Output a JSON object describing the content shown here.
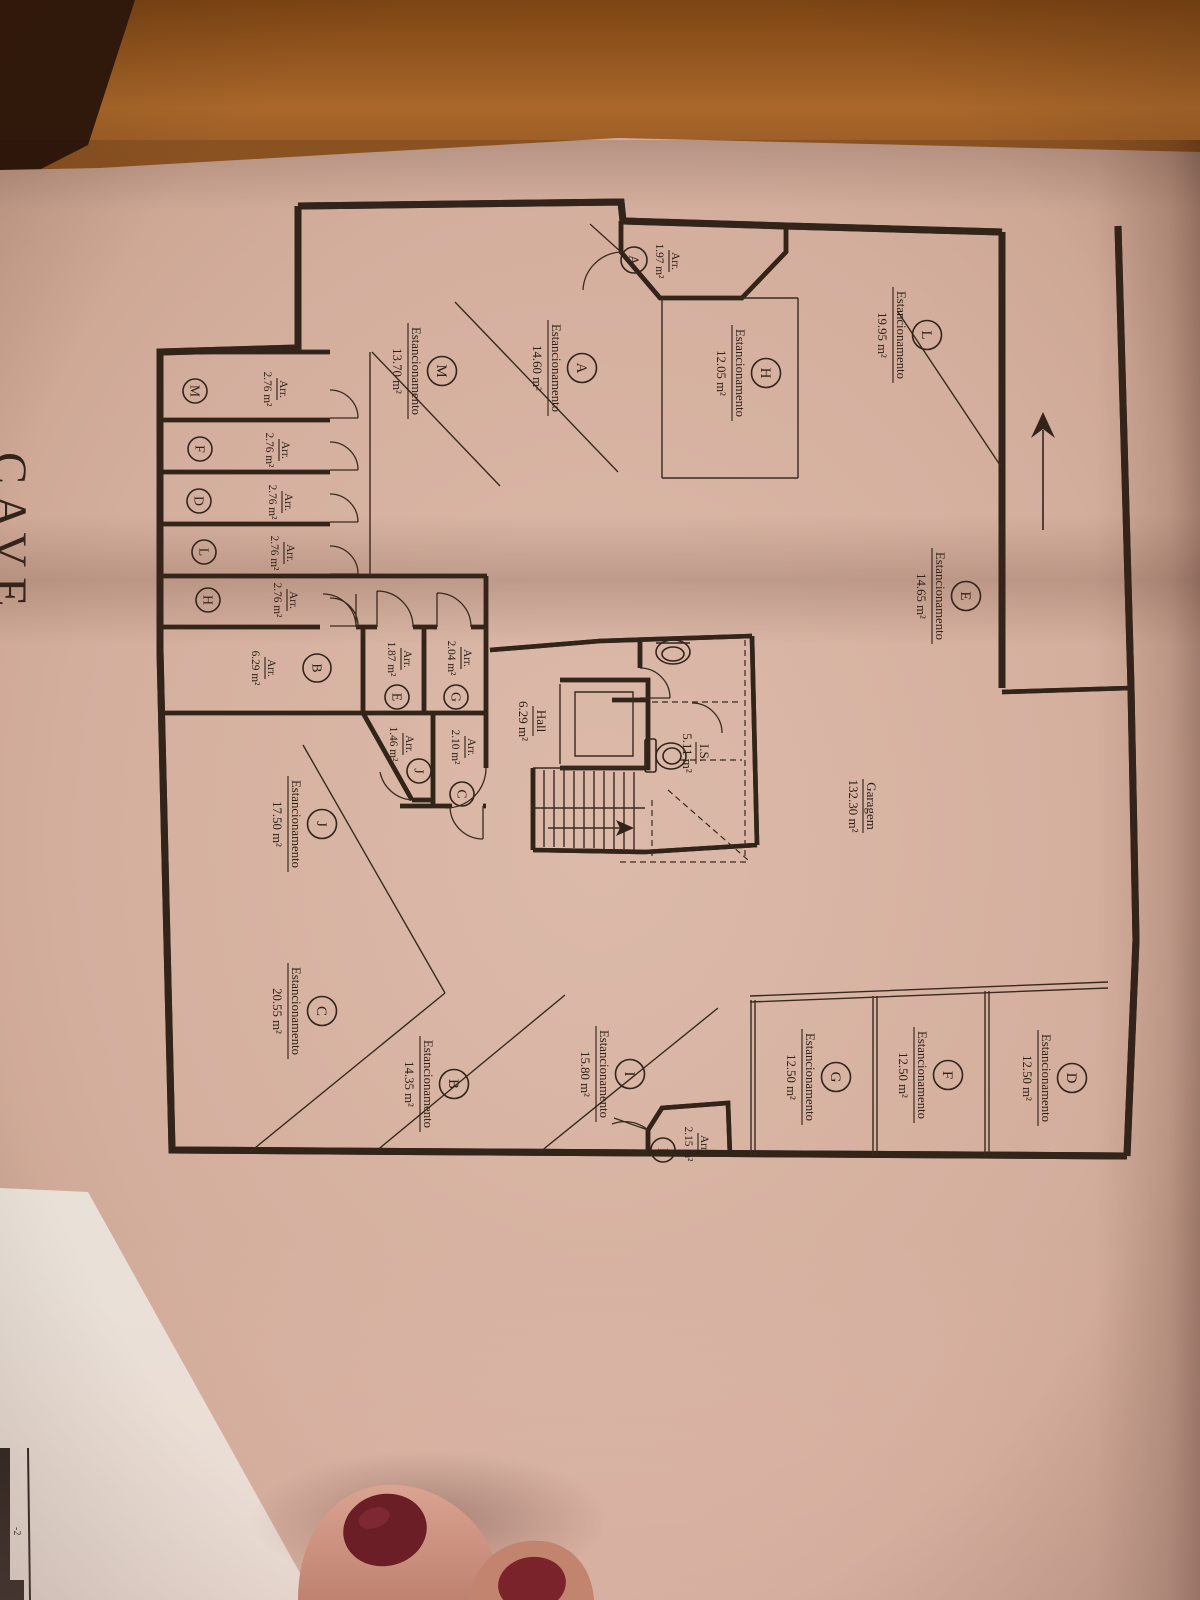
{
  "floor": {
    "label": "CAVE",
    "corner_mark": "-2"
  },
  "terms": {
    "parking": "Estancionamento",
    "storage": "Arr."
  },
  "parking_spaces": [
    {
      "letter": "L",
      "area": "19.95 m²"
    },
    {
      "letter": "H",
      "area": "12.05 m²"
    },
    {
      "letter": "A",
      "area": "14.60 m²"
    },
    {
      "letter": "M",
      "area": "13.70 m²"
    },
    {
      "letter": "E",
      "area": "14.65 m²"
    },
    {
      "letter": "J",
      "area": "17.50 m²"
    },
    {
      "letter": "C",
      "area": "20.55 m²"
    },
    {
      "letter": "B",
      "area": "14.35 m²"
    },
    {
      "letter": "I",
      "area": "15.80 m²"
    },
    {
      "letter": "G",
      "area": "12.50 m²"
    },
    {
      "letter": "F",
      "area": "12.50 m²"
    },
    {
      "letter": "D",
      "area": "12.50 m²"
    }
  ],
  "storages": [
    {
      "letter": "A",
      "area": "1.97 m²"
    },
    {
      "letter": "M",
      "area": "2.76 m²"
    },
    {
      "letter": "F",
      "area": "2.76 m²"
    },
    {
      "letter": "D",
      "area": "2.76 m²"
    },
    {
      "letter": "L",
      "area": "2.76 m²"
    },
    {
      "letter": "H",
      "area": "2.76 m²"
    },
    {
      "letter": "B",
      "area": "6.29 m²"
    },
    {
      "letter": "E",
      "area": "1.87 m²"
    },
    {
      "letter": "G",
      "area": "2.04 m²"
    },
    {
      "letter": "J",
      "area": "1.46 m²"
    },
    {
      "letter": "C",
      "area": "2.10 m²"
    },
    {
      "letter": "I",
      "area": "2.15 m²"
    }
  ],
  "rooms": {
    "hall": {
      "label": "Hall",
      "area": "6.29 m²"
    },
    "wc": {
      "label": "I.S.",
      "area": "5.11 m²"
    },
    "garage": {
      "label": "Garagem",
      "area": "132.30 m²"
    }
  },
  "colors": {
    "paper": "#d4ae9d",
    "ink": "#33241a",
    "wood": "#9a5a22",
    "nail": "#6b1e25"
  }
}
